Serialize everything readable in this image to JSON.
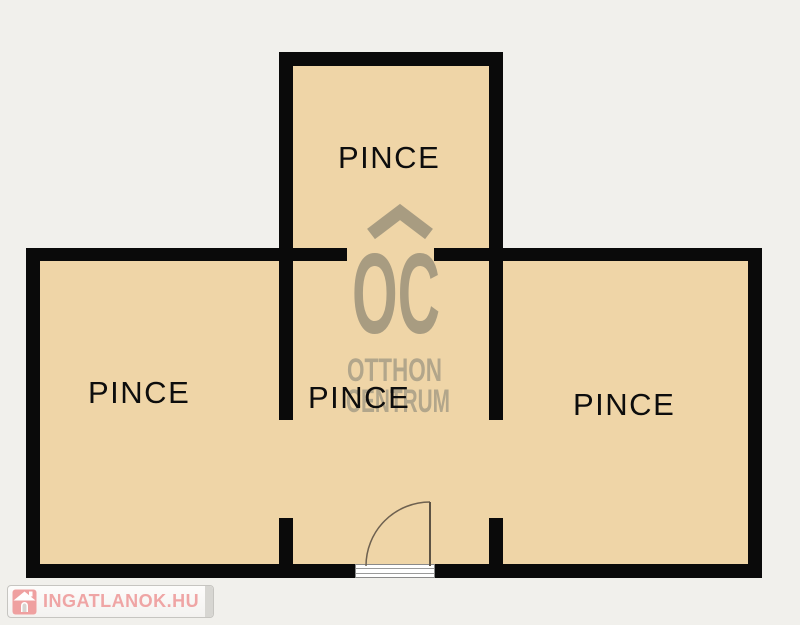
{
  "page": {
    "type": "floor-plan"
  },
  "rooms": [
    {
      "id": "top",
      "label": "PINCE"
    },
    {
      "id": "left",
      "label": "PINCE"
    },
    {
      "id": "middle",
      "label": "PINCE"
    },
    {
      "id": "right",
      "label": "PINCE"
    }
  ],
  "watermark": {
    "monogram": "OC",
    "line1": "OTTHON",
    "line2": "CENTRUM",
    "roof_icon": "roof-chevron"
  },
  "branding": {
    "logo_text": "INGATLANOK.HU",
    "house_icon": "house-icon"
  },
  "colors": {
    "background": "#f1f0ec",
    "room_fill": "#efd5a7",
    "wall": "#0a0a0a",
    "label_text": "#0d0d0d",
    "watermark": "#a89c81",
    "watermark_text": "#b2a68b",
    "door_line": "#6e6150",
    "logo_pink": "#efa5a5",
    "logo_box_border": "#c6c5c1"
  }
}
